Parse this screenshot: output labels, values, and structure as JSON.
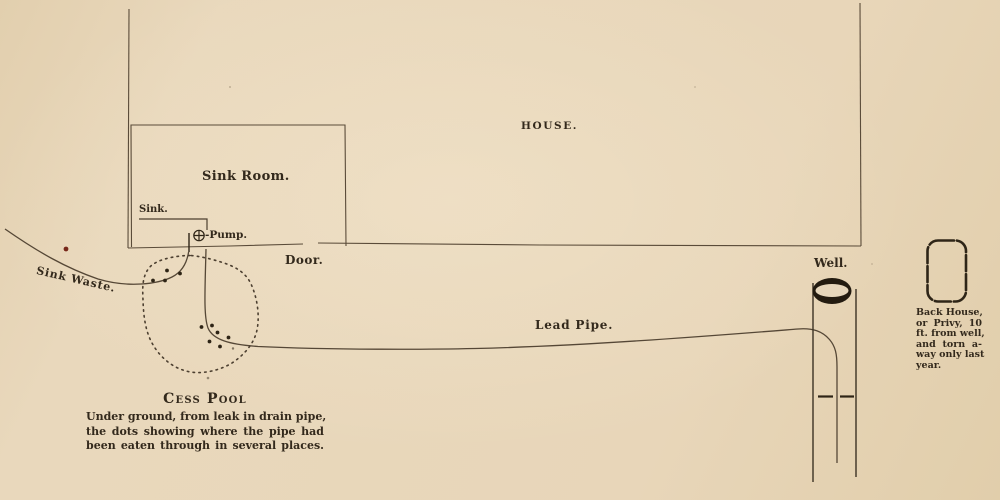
{
  "figure": {
    "kind": "antique-sanitation-diagram",
    "colors": {
      "paper": "#e7d5b8",
      "ink": "#33291c",
      "line": "#5a4b39",
      "well_fill": "#231b10",
      "ink_spot_red": "#77281a"
    }
  },
  "labels": {
    "house": "HOUSE.",
    "sink_room": "Sink Room.",
    "sink": "Sink.",
    "pump": "-Pump.",
    "door": "Door.",
    "sink_waste": "Sink Waste.",
    "lead_pipe": "Lead Pipe.",
    "well": "Well."
  },
  "cesspool": {
    "title": "Cess Pool",
    "note_lines": [
      "Under ground, from leak in drain pipe,",
      "the dots showing where the pipe had",
      "been eaten through in several places."
    ]
  },
  "privy": {
    "lines": [
      "Back House,",
      "or Privy, 10",
      "ft. from well,",
      "and torn a-",
      "way only last",
      "year."
    ]
  },
  "icons": {
    "pump": "circle-cross-icon",
    "well_mouth": "cylinder-top-icon"
  }
}
